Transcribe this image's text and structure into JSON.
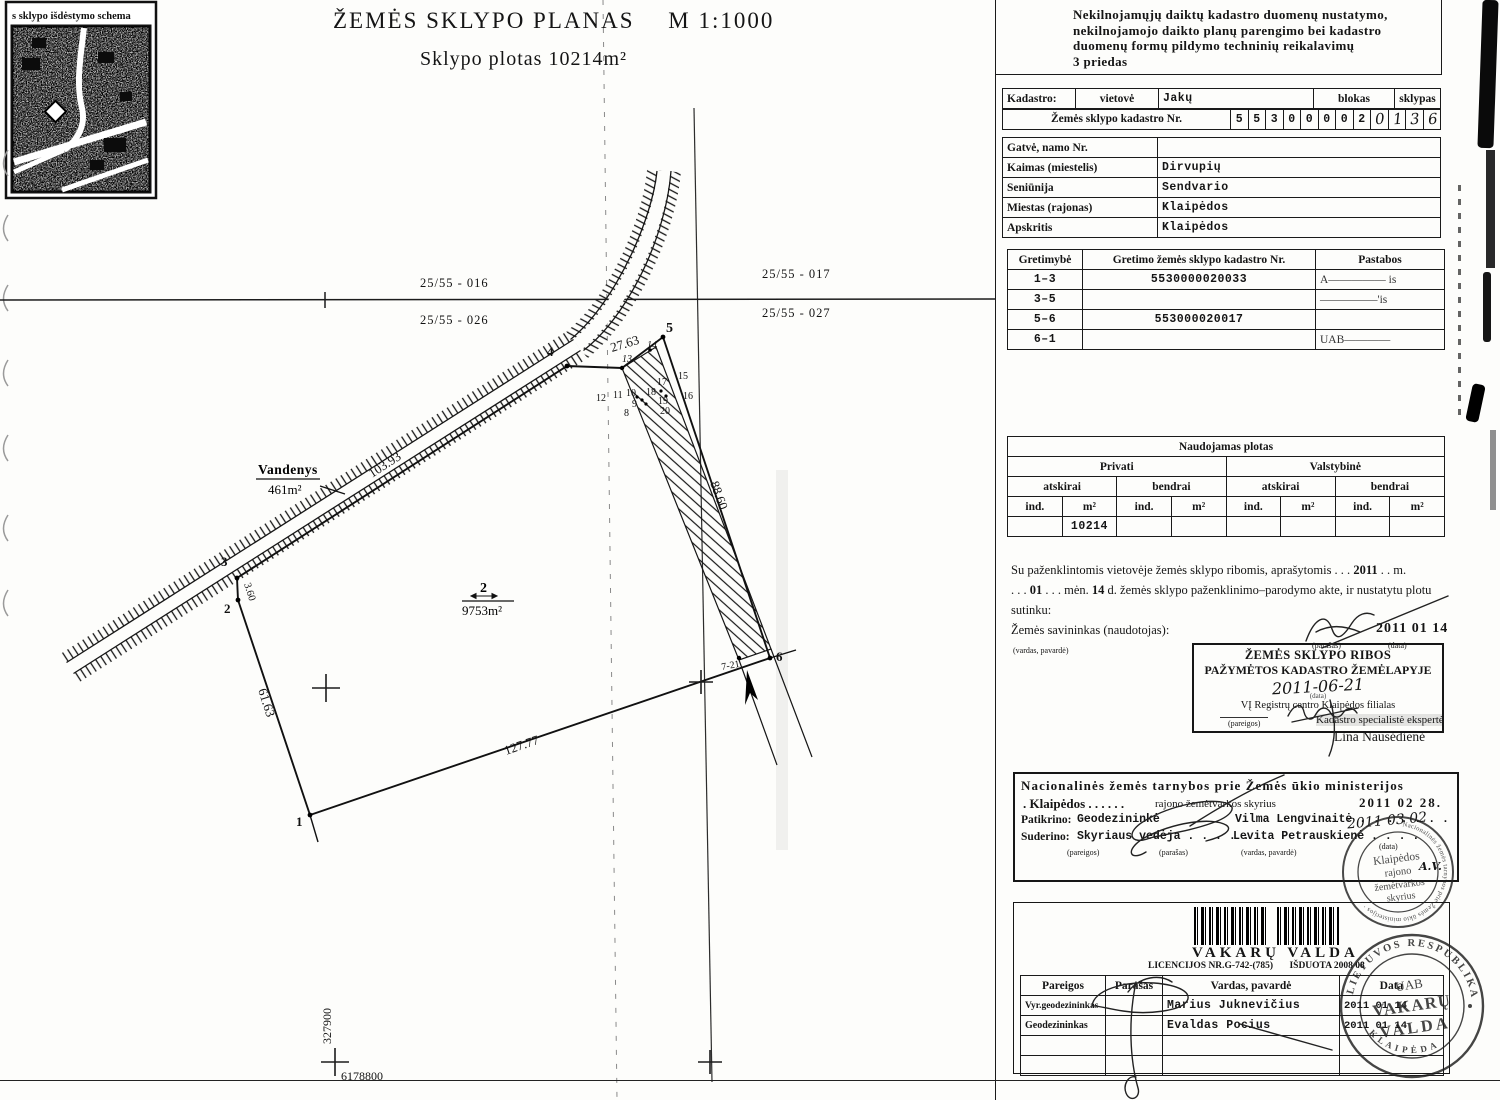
{
  "inset": {
    "label": "s sklypo išdėstymo schema"
  },
  "title": {
    "main": "ŽEMĖS SKLYPO PLANAS",
    "scale": "M 1:1000",
    "subtitle": "Sklypo plotas 10214m²"
  },
  "plan": {
    "q0": "25/55 - 016",
    "q1": "25/55 - 017",
    "q2": "25/55 - 026",
    "q3": "25/55 - 027",
    "vandenys_name": "Vandenys",
    "vandenys_area": "461m²",
    "plot_no": "2",
    "plot_area": "9753m²",
    "dim_45": "27.63",
    "dim_34": "103.93",
    "dim_23": "3.60",
    "dim_12": "61.63",
    "dim_16": "127.77",
    "dim_56": "88.60",
    "p1": "1",
    "p2": "2",
    "p3": "3",
    "p4": "4",
    "p5": "5",
    "p6": "6",
    "p721": "7-21",
    "p8": "8",
    "p9": "9",
    "p10": "10",
    "p11": "11",
    "p12": "12",
    "p13": "13",
    "p14": "14",
    "p15": "15",
    "p16": "16",
    "p17": "17",
    "p18": "18",
    "p19": "19",
    "p20": "20",
    "coord_x": "327900",
    "coord_y": "6178800"
  },
  "form": {
    "header": {
      "l1": "Nekilnojamųjų daiktų kadastro duomenų nustatymo,",
      "l2": "nekilnojamojo daikto planų parengimo bei kadastro",
      "l3": "duomenų formų pildymo techninių reikalavimų",
      "l4": "3 priedas"
    },
    "kadastro": {
      "label": "Kadastro:",
      "vietove": "vietovė",
      "vietove_value": "Jakų",
      "blokas": "blokas",
      "sklypas": "sklypas",
      "nr_label": "Žemės sklypo kadastro Nr.",
      "d0": "5",
      "d1": "5",
      "d2": "3",
      "d3": "0",
      "d4": "0",
      "d5": "0",
      "d6": "0",
      "d7": "2",
      "d8": "0",
      "d9": "1",
      "d10": "3",
      "d11": "6"
    },
    "address": {
      "r0l": "Gatvė, namo Nr.",
      "r0v": "",
      "r1l": "Kaimas (miestelis)",
      "r1v": "Dirvupių",
      "r2l": "Seniūnija",
      "r2v": "Sendvario",
      "r3l": "Miestas (rajonas)",
      "r3v": "Klaipėdos",
      "r4l": "Apskritis",
      "r4v": "Klaipėdos"
    },
    "gretimybe": {
      "h0": "Gretimybė",
      "h1": "Gretimo žemės sklypo kadastro Nr.",
      "h2": "Pastabos",
      "r0c0": "1–3",
      "r0c1": "5530000020033",
      "r0c2": "A————— is",
      "r1c0": "3–5",
      "r1c1": "",
      "r1c2": "—————'is",
      "r2c0": "5–6",
      "r2c1": "553000020017",
      "r2c2": "",
      "r3c0": "6–1",
      "r3c1": "",
      "r3c2": "UAB————"
    },
    "naudojamas": {
      "title": "Naudojamas plotas",
      "privati": "Privati",
      "valstybine": "Valstybinė",
      "atskirai": "atskirai",
      "bendrai": "bendrai",
      "ind": "ind.",
      "m2": "m²",
      "v": "10214"
    },
    "agreement": {
      "t1a": "Su paženklintomis vietovėje žemės sklypo ribomis, aprašytomis . . .",
      "t1b": "2011",
      "t1c": ". . m.",
      "t2a": ". . .",
      "t2b": "01",
      "t2c": ". . . mėn.",
      "t2d": "14",
      "t2e": "d. žemės sklypo paženklinimo–parodymo akte, ir nustatytu plotu sutinku:",
      "t3": "Žemės savininkas (naudotojas):",
      "vardas": "(vardas, pavardė)",
      "parasas": "(parašas)",
      "data": "(data)",
      "date": "2011 01 14"
    },
    "ribos": {
      "l1": "ŽEMĖS SKLYPO RIBOS",
      "l2": "PAŽYMĖTOS KADASTRO ŽEMĖLAPYJE",
      "hand_date": "2011-06-21",
      "data_label": "(data)",
      "org": "VĮ Registrų centro Klaipėdos filialas",
      "pareigos": "(pareigos)",
      "parasas": "(parašas)",
      "specialist": "Kadastro specialistė ekspertė",
      "name": "Lina Nausėdienė"
    },
    "national": {
      "l1": "Nacionalinės žemės tarnybos prie Žemės ūkio ministerijos",
      "l2a": ". Klaipėdos . . . . . .",
      "l2b": "rajono žemėtvarkos skyrius",
      "stamp_date": "2011 02 28.",
      "patikrino": "Patikrino:",
      "p_role": "Geodezininkė",
      "p_name": "Vilma Lengvinaitė . . . . . . .",
      "hand_date": "2011 03 02",
      "suderino": "Suderino:",
      "s_role": "Skyriaus vedėja . . . . .",
      "s_name": "Levita Petrauskienė . . . .",
      "pareigos": "(pareigos)",
      "parasas": "(parašas)",
      "vardas": "(vardas, pavardė)",
      "data": "(data)",
      "av": "A.V."
    },
    "stamp1": {
      "ring": "· Nacionalinės žemės tarnybos prie Žemės ūkio ministerijos ·",
      "c0": "Klaipėdos",
      "c1": "rajono",
      "c2": "žemėtvarkos",
      "c3": "skyrius"
    },
    "vakaru": {
      "company": "VAKARŲ VALDA",
      "lic": "LICENCIJOS NR.G-742-(785)",
      "isduota": "IŠDUOTA 2008 08",
      "h0": "Pareigos",
      "h1": "Parašas",
      "h2": "Vardas, pavardė",
      "h3": "Data",
      "r0c0": "Vyr.geodezininkas",
      "r0c2": "Marius Juknevičius",
      "r0c3": "2011 01 14",
      "r1c0": "Geodezininkas",
      "r1c2": "Evaldas Pocius",
      "r1c3": "2011 01 14"
    },
    "stamp2": {
      "top": "LIETUVOS RESPUBLIKA",
      "bottom": "K L A I P Ė D A",
      "c0": "UAB",
      "c1": "VAKARŲ",
      "c2": "VALDA"
    }
  }
}
